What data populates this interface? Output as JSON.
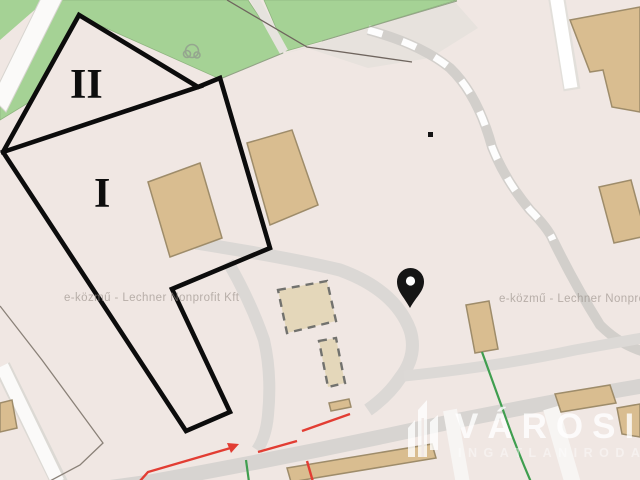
{
  "map_view": {
    "type": "utility-map-screenshot",
    "annotations": {
      "zone_label_primary": "I",
      "zone_label_secondary": "II"
    },
    "watermarks": {
      "left": "e-közmű - Lechner Nonprofit Kft",
      "right": "e-közmű - Lechner Nonprofit Kft"
    },
    "brand": {
      "name": "VÁROSI",
      "tagline": "INGATLANIRODA"
    },
    "colors": {
      "background": "#f0e7e3",
      "park_green": "#a5d295",
      "building_tan": "#d9bd90",
      "building_border": "#9e8c6a",
      "road_gray": "#d9d6d3",
      "road_white": "#fbfaf9",
      "annotation_black": "#0c0c0c",
      "utility_electric_red": "#e23d33",
      "utility_gas_green": "#3f9e4f"
    },
    "icons": [
      "location-pin-icon",
      "tree-icon",
      "brand-buildings-icon"
    ]
  }
}
